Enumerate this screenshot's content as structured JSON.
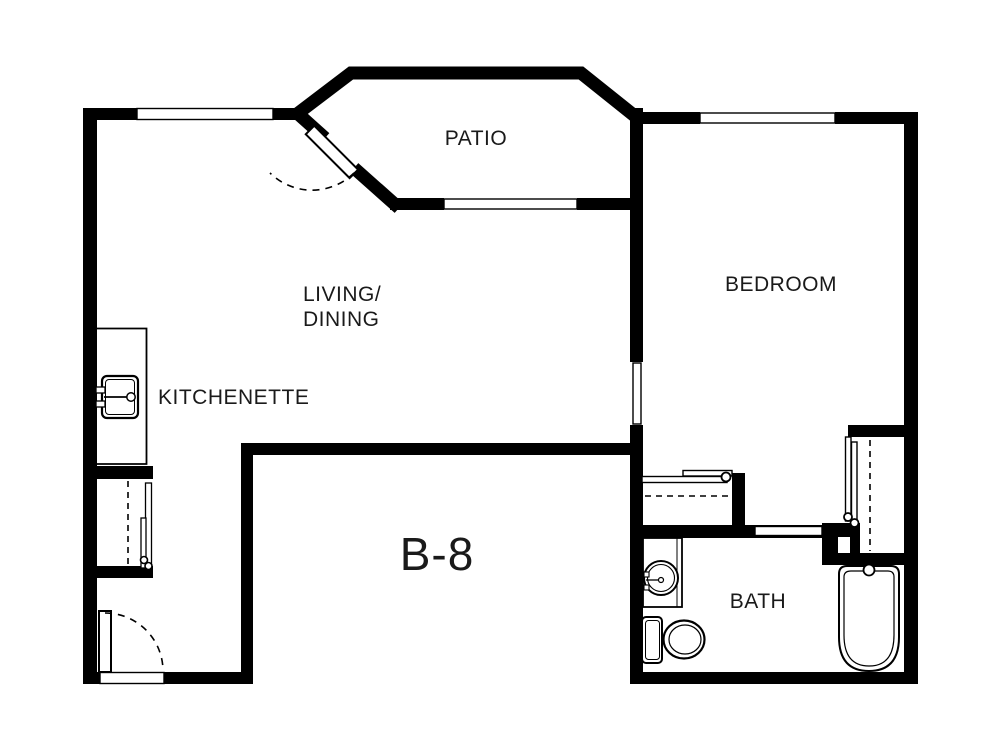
{
  "floorplan": {
    "unit_label": "B-8",
    "rooms": {
      "patio": {
        "label": "PATIO"
      },
      "living_dining": {
        "line1": "LIVING/",
        "line2": "DINING"
      },
      "kitchenette": {
        "label": "KITCHENETTE"
      },
      "bedroom": {
        "label": "BEDROOM"
      },
      "bath": {
        "label": "BATH"
      }
    },
    "fixtures": [
      "kitchen-sink",
      "vanity-sink",
      "toilet",
      "bathtub"
    ],
    "doors": [
      "patio-hinged-door",
      "entry-hinged-door",
      "bedroom-pocket-door",
      "bath-pocket-door",
      "closet-sliding-doors",
      "kitchen-closet-sliding-doors"
    ],
    "windows": [
      "living-room-window",
      "patio-window",
      "bedroom-window"
    ],
    "colors": {
      "wall": "#000000",
      "background": "#ffffff",
      "text": "#1a1a1a"
    }
  }
}
